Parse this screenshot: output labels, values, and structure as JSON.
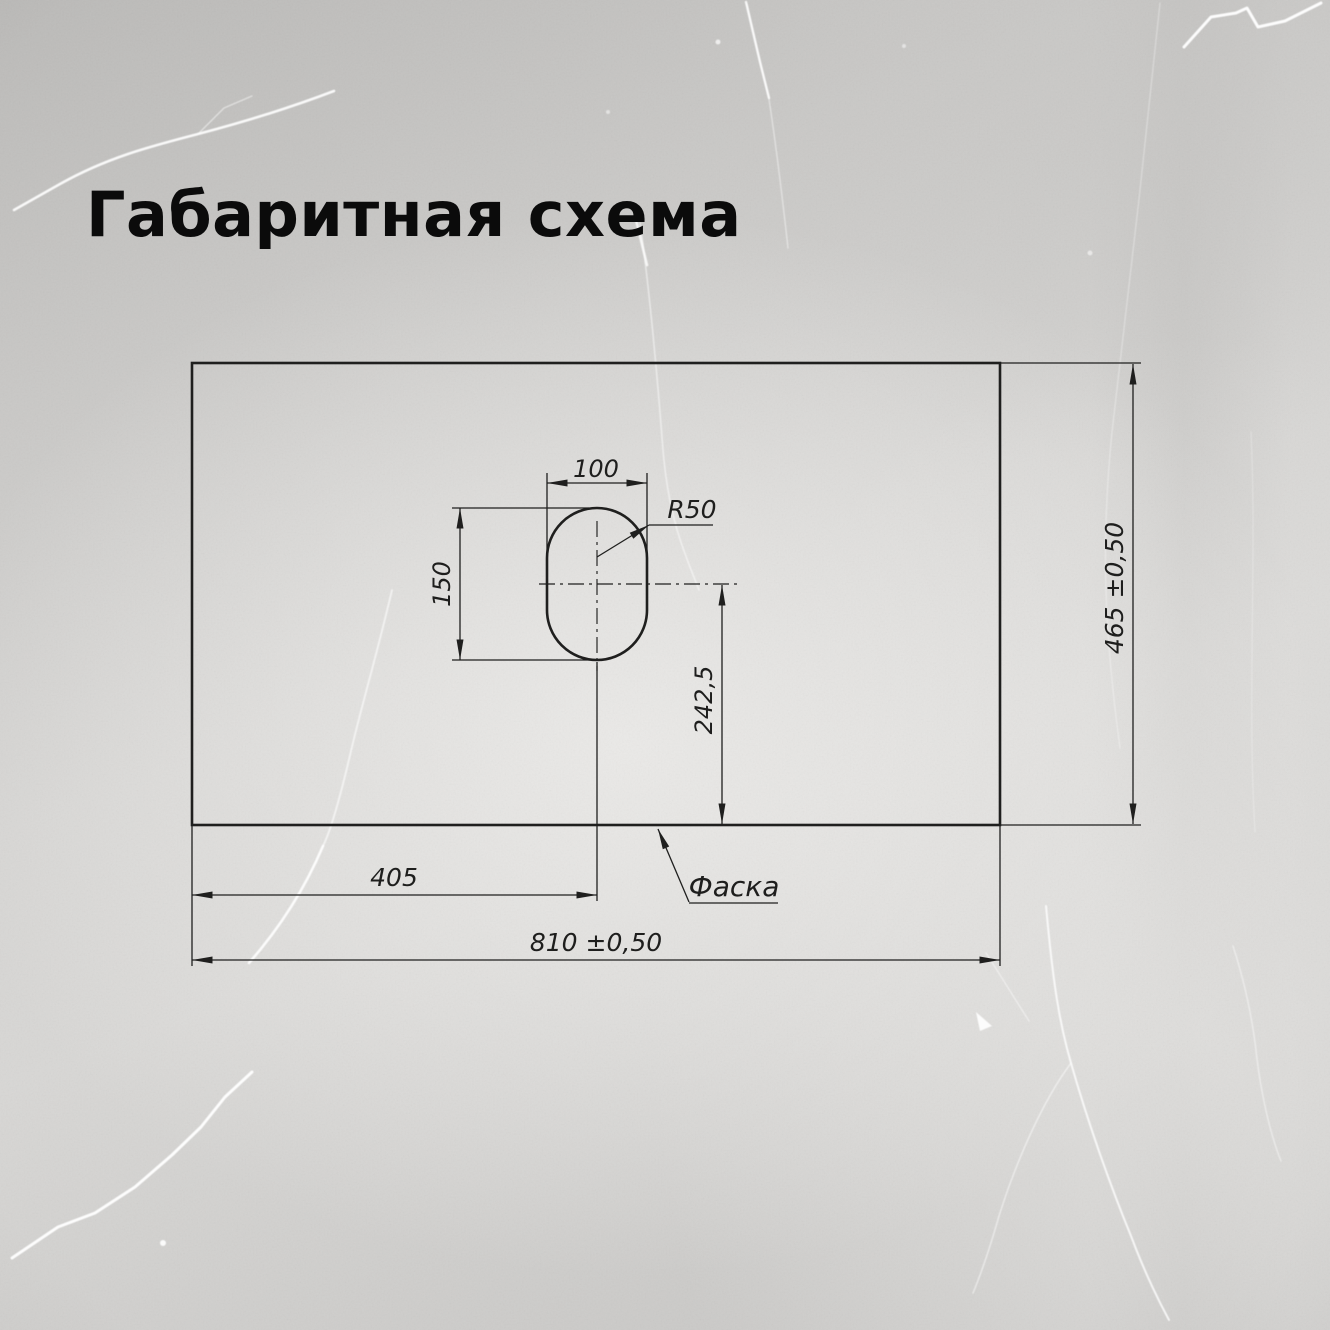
{
  "title": "Габаритная схема",
  "colors": {
    "background_base": "#cac9c7",
    "line": "#1f1f1e",
    "dimension_text": "#1e1e1d",
    "title_text": "#0b0b0b",
    "vein": "#ffffff"
  },
  "diagram": {
    "type": "dimensional-drawing",
    "panel": {
      "description": "rectangular countertop panel outline",
      "width_label": "810 ±0,50",
      "height_label": "465 ±0,50"
    },
    "cutout": {
      "shape": "stadium (rounded oval) hole",
      "width_label": "100",
      "height_label": "150",
      "radius_label": "R50",
      "offset_from_left_label": "405",
      "offset_from_bottom_label": "242,5"
    },
    "chamfer_label": "Фаска"
  }
}
